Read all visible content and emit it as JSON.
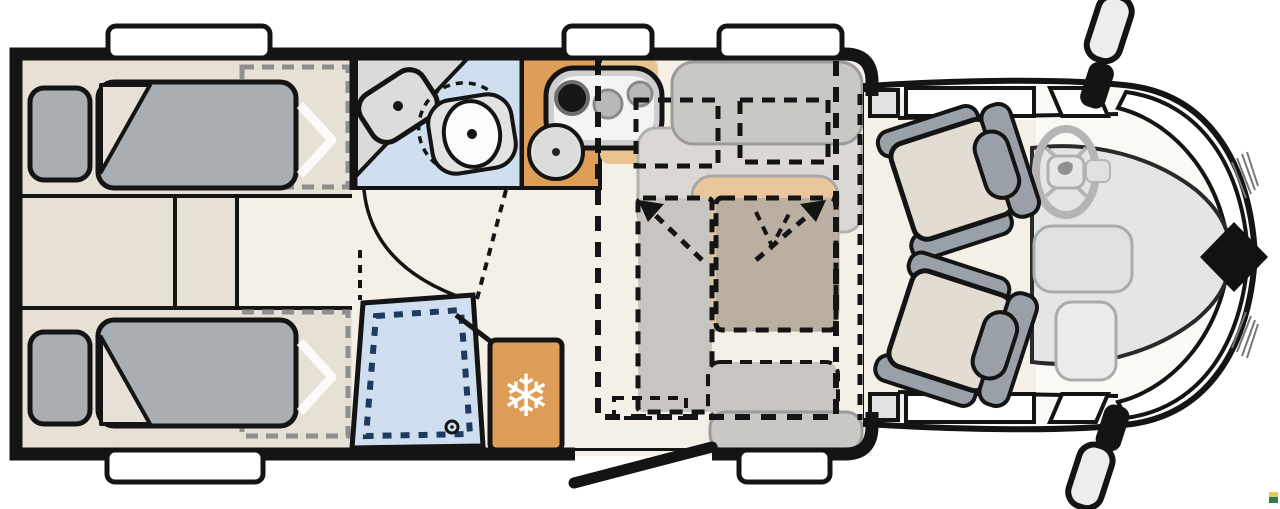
{
  "floorplan": {
    "type": "motorhome-floorplan-top-view",
    "icons": {
      "fridge_snowflake": "❄"
    },
    "colors": {
      "background": "#ffffff",
      "wall": "#141414",
      "floor": "#f5f0e7",
      "bedroom_floor": "#e7e0d5",
      "bedding_gray": "#a9aeb3",
      "bathroom_blue": "#cfdff0",
      "bathroom_counter": "#dadada",
      "shower_dash_navy": "#1e3a5f",
      "kitchen_orange": "#df9e58",
      "kitchen_orange_light": "#eac48f",
      "fridge_orange": "#df9e58",
      "bench_gray": "#cac8c4",
      "cushion_gray": "#dbd8d3",
      "bed_overlay_brown": "#bbafa2",
      "bed_overlay_gray": "#c8c5c1",
      "table_tan": "#eac79a",
      "cab_seat_beige": "#e3dcd3",
      "cab_seat_frame": "#99a0a7",
      "cab_hood_gray": "#e5e5e5",
      "windshield_white": "#ffffff",
      "diamond_black": "#111111",
      "watermark_yellow": "#e5c94f",
      "watermark_green": "#2f7c51"
    },
    "areas": {
      "rear_bedroom": "twin single beds",
      "bathroom": "washroom with basin and toilet",
      "shower": "shower tray",
      "kitchen": "kitchenette with hob and sink",
      "fridge": "refrigerator",
      "dinette": "dinette with table and drop-down bed",
      "cab": "driver cab with swivel seats",
      "entry": "entry door"
    }
  }
}
